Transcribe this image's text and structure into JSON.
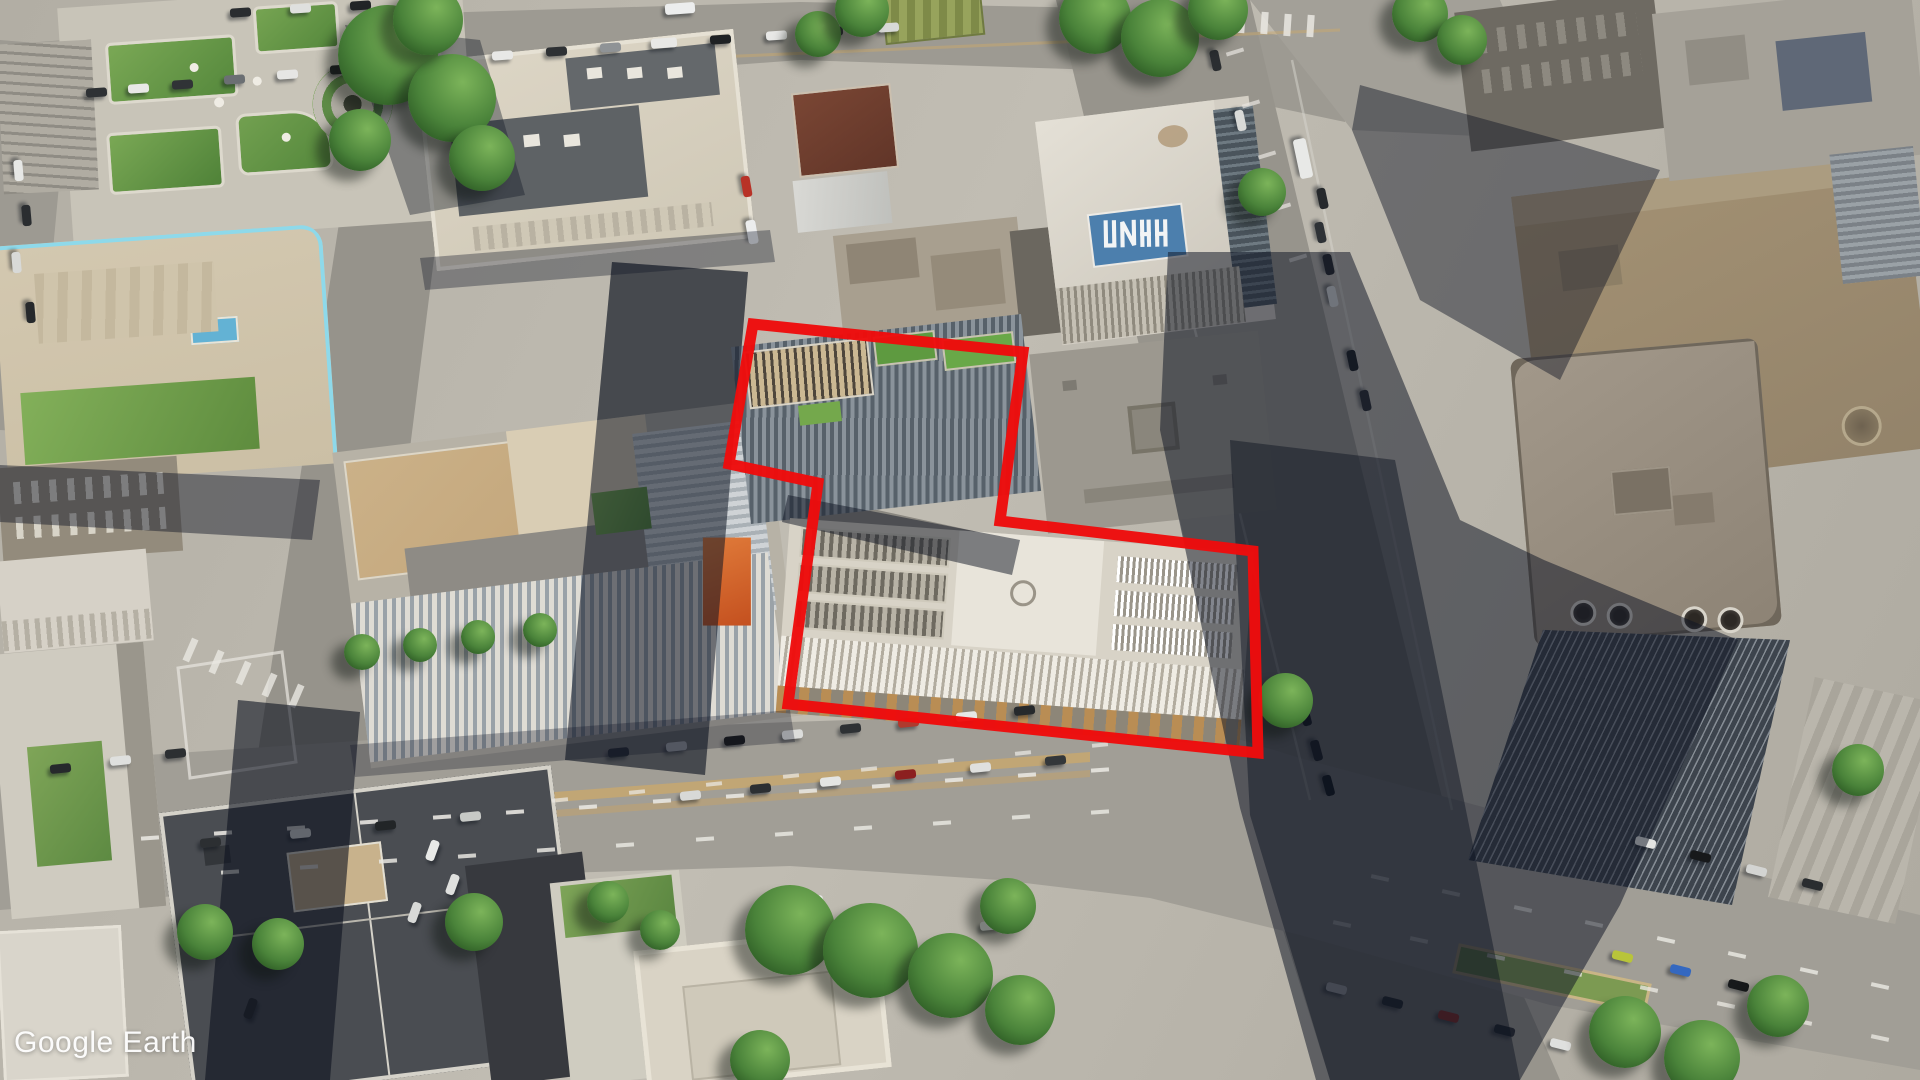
{
  "watermark": {
    "text": "Google Earth"
  },
  "highlight": {
    "color": "#ee0c0c",
    "stroke_width": 11,
    "points": "753,324 1023,352 1000,521 1253,551 1258,753 788,704 818,483 729,464"
  },
  "rooftop_logo": {
    "panel_color": "#4c7fad",
    "glyph_color": "#f2f4f5"
  },
  "palette": {
    "pavement": "#b5b1a7",
    "road": "#9d9a92",
    "shadow": "rgba(15,21,36,0.52)",
    "median_line": "#c9a86d",
    "park_green": "#6f9c48"
  },
  "scene": {
    "cars": [
      [
        96,
        92,
        -4,
        "#2e3134"
      ],
      [
        138,
        88,
        -4,
        "#e8e8e6"
      ],
      [
        182,
        84,
        -4,
        "#303336"
      ],
      [
        234,
        79,
        -4,
        "#6b6f73"
      ],
      [
        287,
        74,
        -4,
        "#e6e6e4"
      ],
      [
        340,
        69,
        -4,
        "#1f2224"
      ],
      [
        394,
        64,
        -4,
        "#caccc9"
      ],
      [
        448,
        59,
        -4,
        "#2e3134"
      ],
      [
        502,
        55,
        -4,
        "#e8e8e6"
      ],
      [
        556,
        51,
        -4,
        "#2e3134"
      ],
      [
        610,
        47,
        -4,
        "#8f9396"
      ],
      [
        664,
        43,
        -4,
        "#e8e8e6",
        26,
        10
      ],
      [
        720,
        39,
        -4,
        "#1f2224"
      ],
      [
        776,
        35,
        -4,
        "#e8e8e6"
      ],
      [
        832,
        31,
        -4,
        "#2e3134"
      ],
      [
        888,
        27,
        -4,
        "#d7d9d6"
      ],
      [
        240,
        12,
        -4,
        "#2a2d30"
      ],
      [
        300,
        8,
        -4,
        "#dfe0de"
      ],
      [
        360,
        5,
        -4,
        "#222527"
      ],
      [
        680,
        8,
        -4,
        "#eceded",
        30,
        11
      ],
      [
        18,
        170,
        85,
        "#e6e7e5"
      ],
      [
        26,
        215,
        85,
        "#2a2d30"
      ],
      [
        16,
        262,
        85,
        "#d8d9d7"
      ],
      [
        30,
        312,
        85,
        "#26292c"
      ],
      [
        746,
        186,
        80,
        "#b83227"
      ],
      [
        752,
        232,
        80,
        "#eceded",
        24,
        10
      ],
      [
        1303,
        158,
        78,
        "#e8e9e7",
        40,
        13
      ],
      [
        1322,
        198,
        78,
        "#26292c"
      ],
      [
        1320,
        232,
        78,
        "#2e3236"
      ],
      [
        1328,
        264,
        78,
        "#24272a"
      ],
      [
        1332,
        296,
        78,
        "#dadbd9"
      ],
      [
        1352,
        360,
        78,
        "#1d2023"
      ],
      [
        1365,
        400,
        78,
        "#2a2d31"
      ],
      [
        1240,
        120,
        78,
        "#d8d9d7"
      ],
      [
        1215,
        60,
        78,
        "#2b2e31"
      ],
      [
        1305,
        715,
        75,
        "#1a1d20"
      ],
      [
        1316,
        750,
        75,
        "#222528"
      ],
      [
        1328,
        785,
        75,
        "#16181b"
      ],
      [
        690,
        795,
        -6,
        "#d8d9d7"
      ],
      [
        760,
        788,
        -6,
        "#2c2f32"
      ],
      [
        830,
        781,
        -6,
        "#e4e5e3"
      ],
      [
        905,
        774,
        -6,
        "#8c2020"
      ],
      [
        980,
        767,
        -6,
        "#dfe0de"
      ],
      [
        1055,
        760,
        -6,
        "#33373a"
      ],
      [
        470,
        816,
        -6,
        "#c7c9c6"
      ],
      [
        385,
        825,
        -6,
        "#222527"
      ],
      [
        300,
        833,
        -6,
        "#e2e3e1"
      ],
      [
        210,
        842,
        -6,
        "#2c2f32"
      ],
      [
        618,
        752,
        -6,
        "#2e3134"
      ],
      [
        676,
        746,
        -6,
        "#e6e7e5"
      ],
      [
        734,
        740,
        -6,
        "#17191b"
      ],
      [
        792,
        734,
        -6,
        "#dcdddb"
      ],
      [
        850,
        728,
        -6,
        "#2e3134"
      ],
      [
        908,
        722,
        -6,
        "#b03a2e"
      ],
      [
        966,
        716,
        -6,
        "#e6e7e5"
      ],
      [
        1024,
        710,
        -6,
        "#26292c"
      ],
      [
        432,
        850,
        -70,
        "#e8e9e7"
      ],
      [
        452,
        884,
        -70,
        "#dfe0de"
      ],
      [
        414,
        912,
        -70,
        "#d8d9d7"
      ],
      [
        250,
        1008,
        -70,
        "#26292c"
      ],
      [
        272,
        952,
        -70,
        "#1d2022"
      ],
      [
        1645,
        842,
        14,
        "#e4e5e3"
      ],
      [
        1700,
        856,
        14,
        "#17191b"
      ],
      [
        1756,
        870,
        14,
        "#d3d4d2"
      ],
      [
        1812,
        884,
        14,
        "#2a2d30"
      ],
      [
        1336,
        988,
        14,
        "#dfe0de"
      ],
      [
        1392,
        1002,
        14,
        "#2c2f32"
      ],
      [
        1448,
        1016,
        14,
        "#c0392b"
      ],
      [
        1504,
        1030,
        14,
        "#2c2f32"
      ],
      [
        1560,
        1044,
        14,
        "#dfe0de"
      ],
      [
        1622,
        956,
        14,
        "#b8c43a"
      ],
      [
        1680,
        970,
        14,
        "#3468c0"
      ],
      [
        1738,
        985,
        14,
        "#17191b"
      ],
      [
        1794,
        1000,
        14,
        "#d8d9d7"
      ],
      [
        60,
        768,
        -6,
        "#26292c"
      ],
      [
        120,
        760,
        -6,
        "#dfe0de"
      ],
      [
        175,
        753,
        -6,
        "#2c2f32"
      ],
      [
        812,
        900,
        -6,
        "#e8e9e7"
      ],
      [
        865,
        908,
        -6,
        "#dfe0de"
      ],
      [
        990,
        925,
        -6,
        "#d8d9d7"
      ]
    ],
    "trees": [
      [
        388,
        55,
        100
      ],
      [
        452,
        98,
        88
      ],
      [
        428,
        20,
        70
      ],
      [
        360,
        140,
        62
      ],
      [
        482,
        158,
        66
      ],
      [
        818,
        34,
        46
      ],
      [
        862,
        10,
        54
      ],
      [
        1095,
        18,
        72
      ],
      [
        1160,
        38,
        78
      ],
      [
        1218,
        10,
        60
      ],
      [
        1262,
        192,
        48
      ],
      [
        1420,
        14,
        56
      ],
      [
        1462,
        40,
        50
      ],
      [
        205,
        932,
        56
      ],
      [
        278,
        944,
        52
      ],
      [
        474,
        922,
        58
      ],
      [
        608,
        902,
        42
      ],
      [
        660,
        930,
        40
      ],
      [
        790,
        930,
        90
      ],
      [
        870,
        950,
        95
      ],
      [
        950,
        975,
        85
      ],
      [
        1020,
        1010,
        70
      ],
      [
        760,
        1060,
        60
      ],
      [
        1008,
        906,
        56
      ],
      [
        1625,
        1032,
        72
      ],
      [
        1702,
        1058,
        76
      ],
      [
        1778,
        1006,
        62
      ],
      [
        1858,
        770,
        52
      ],
      [
        1285,
        700,
        55
      ],
      [
        362,
        652,
        36
      ],
      [
        420,
        645,
        34
      ],
      [
        478,
        637,
        34
      ],
      [
        540,
        630,
        34
      ]
    ],
    "road_lines": [
      {
        "p": [
          150,
          838,
          1100,
          770
        ],
        "n": 14,
        "w": 18,
        "h": 4,
        "c": "#e8e6e0",
        "o": 0.9
      },
      {
        "p": [
          230,
          872,
          1100,
          812
        ],
        "n": 12,
        "w": 18,
        "h": 4,
        "c": "#e8e6e0",
        "o": 0.85
      },
      {
        "p": [
          560,
          800,
          1100,
          745
        ],
        "n": 8,
        "w": 16,
        "h": 4,
        "c": "#e8e6e0",
        "o": 0.75
      },
      {
        "p": [
          1380,
          878,
          1880,
          986
        ],
        "n": 8,
        "w": 18,
        "h": 4,
        "c": "#e8e6e0",
        "o": 0.85
      },
      {
        "p": [
          1342,
          924,
          1880,
          1038
        ],
        "n": 8,
        "w": 18,
        "h": 4,
        "c": "#e8e6e0",
        "o": 0.8
      },
      {
        "p": [
          1218,
          20,
          1310,
          26
        ],
        "n": 5,
        "w": 7,
        "h": 22,
        "c": "#eae8e2",
        "o": 0.85
      },
      {
        "p": [
          1235,
          52,
          1298,
          258
        ],
        "n": 5,
        "w": 4,
        "h": 18,
        "c": "#e8e6e0",
        "o": 0.7
      },
      {
        "p": [
          190,
          650,
          296,
          696
        ],
        "n": 5,
        "w": 7,
        "h": 24,
        "c": "#eae8e2",
        "o": 0.8
      }
    ]
  }
}
